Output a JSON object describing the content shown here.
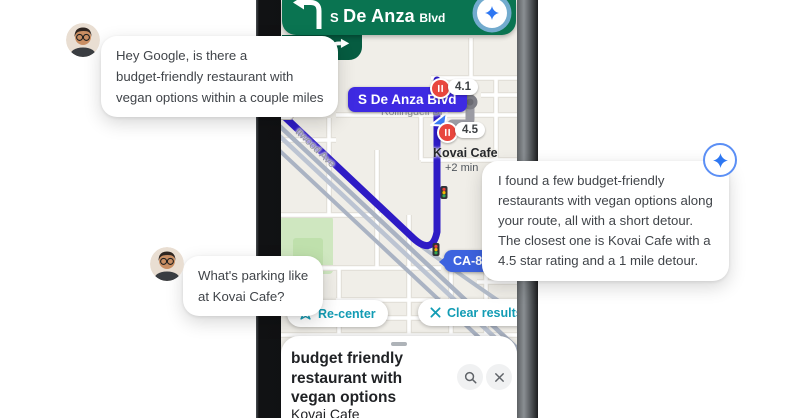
{
  "colors": {
    "banner_green": "#0a7451",
    "then_chip_green": "#065c41",
    "route_indigo": "#2e1bc5",
    "street_label_blue": "#3e2ae2",
    "highway_label_blue": "#3d63df",
    "action_teal": "#129cb4",
    "pin_red": "#e8463d",
    "assistant_blue": "#2e77f2"
  },
  "phone": {
    "nav": {
      "distance": "0 ft",
      "street_prefix": "S",
      "street_name": "De Anza",
      "street_suffix": "Blvd"
    },
    "map": {
      "shield": "85",
      "street_rotated": "ttwood Ave",
      "street_cross": "Rollingdell Dr",
      "street_current_label": "S De Anza Blvd",
      "rating_top": "4.1",
      "rating_near": "4.5",
      "poi_name": "Kovai Cafe",
      "poi_eta": "+2 min",
      "highway_label": "CA-85 N"
    },
    "buttons": {
      "recenter": "Re-center",
      "clear": "Clear results"
    },
    "sheet": {
      "query_line1": "budget friendly",
      "query_line2": "restaurant with",
      "query_line3": "vegan options",
      "result_preview": "Kovai Cafe"
    }
  },
  "bubbles": {
    "user1": {
      "line1": "Hey Google, is there a",
      "line2": "budget-friendly restaurant with",
      "line3": "vegan options within a couple miles"
    },
    "assistant": {
      "line1": "I found a few budget-friendly",
      "line2": "restaurants with vegan options along",
      "line3": "your route, all with a short detour.",
      "line4": "The closest one is Kovai Cafe with a",
      "line5": "4.5 star rating and a 1 mile detour."
    },
    "user2": {
      "line1": "What's parking like",
      "line2": "at Kovai Cafe?"
    }
  }
}
